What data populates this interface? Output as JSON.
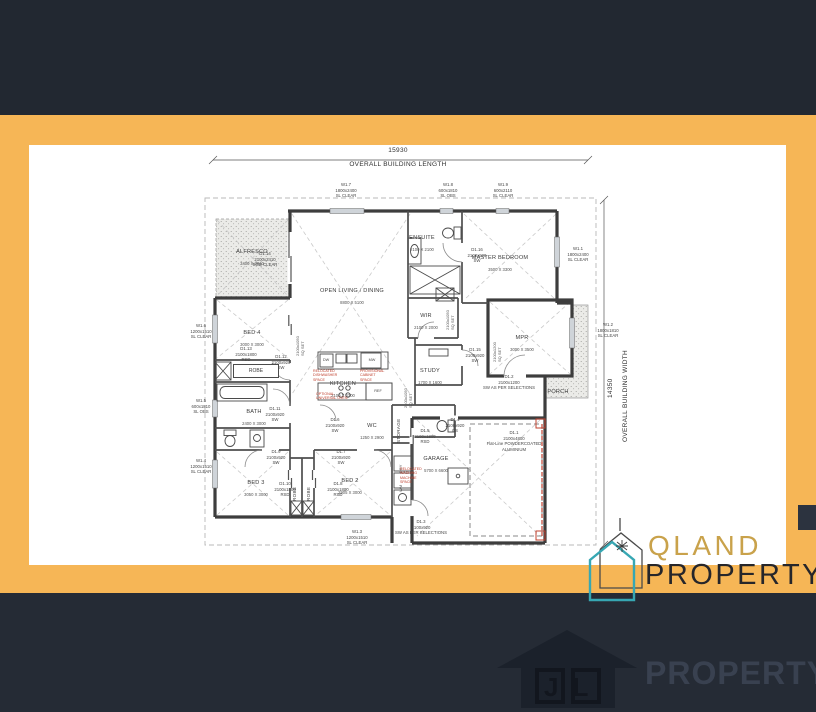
{
  "dimensions": {
    "length_value": "15930",
    "length_label": "OVERALL BUILDING LENGTH",
    "width_value": "14350",
    "width_label": "OVERALL BUILDING WIDTH"
  },
  "windows": {
    "w1_1": "W1.1\n1800x2400\nSL CLEAR",
    "w1_2": "W1.2\n1800x1810\nSL CLEAR",
    "w1_3": "W1.3\n1200x1510\nSL CLEAR",
    "w1_4": "W1.4\n1200x1510\nSL CLEAR",
    "w1_5": "W1.5\n600x1810\nSL OBS",
    "w1_6": "W1.6\n1200x1510\nSL CLEAR",
    "w1_7": "W1.7\n1800x2400\nSL CLEAR",
    "w1_8": "W1.8\n600x1810\nSL OBS",
    "w1_9": "W1.9\n600x2110\nSL CLEAR"
  },
  "doors": {
    "d1_1": "D1.1\n2100x4800\nFlat-Line POWDERCOATED\nALUMINIUM",
    "d1_2": "D1.2\n2100x1200\nSW AS PER SELECTIONS",
    "d1_3": "D1.3\n2100x920\nSW AS PER SELECTIONS",
    "d1_4": "D1.4\n2100x920\nCS",
    "d1_5": "D1.5\n2100x1800\nRSD",
    "d1_6": "D1.6\n2100x920\nSW",
    "d1_7": "D1.7\n2100x920\nSW",
    "d1_8": "D1.8\n2100x1800\nRSD",
    "d1_9": "D1.9\n2100x920\nSW",
    "d1_10": "D1.10\n2100x1800\nRSD",
    "d1_11": "D1.11\n2100x920\nSW",
    "d1_12": "D1.12\n2100x920\nSW",
    "d1_13": "D1.13\n2100x1800\nRSD",
    "d1_14": "D1.14\n2100x2410\nSGD CLEAR",
    "d1_15": "D1.15\n2100x920\nSW",
    "d1_16": "D1.16\n2100x920\nSW"
  },
  "rooms": {
    "alfresco": {
      "name": "ALFRESCO",
      "dims": "3400 X 3010"
    },
    "living": {
      "name": "OPEN LIVING / DINING",
      "dims": "8800 X 5100"
    },
    "ensuite": {
      "name": "ENSUITE",
      "dims": "2100 X 2100"
    },
    "master": {
      "name": "MASTER BEDROOM",
      "dims": "3500 X 3300"
    },
    "wir": {
      "name": "WIR",
      "dims": "2100 X 2000"
    },
    "study": {
      "name": "STUDY",
      "dims": "1700 X 1600"
    },
    "mpr": {
      "name": "MPR",
      "dims": "3000 X 3500"
    },
    "bed4": {
      "name": "BED 4",
      "dims": "3000 X 3000"
    },
    "bath": {
      "name": "BATH",
      "dims": "2400 X 3000"
    },
    "kitchen": {
      "name": "KITCHEN",
      "dims": "2100 X 4300"
    },
    "wc": {
      "name": "WC",
      "dims": "1250 X 2900"
    },
    "bed3": {
      "name": "BED 3",
      "dims": "3050 X 3000"
    },
    "bed2": {
      "name": "BED 2",
      "dims": "2905 X 3000"
    },
    "garage": {
      "name": "GARAGE",
      "dims": "5700 X 6600"
    },
    "porch": {
      "name": "PORCH"
    },
    "robe1": "ROBE",
    "robe2": "ROBE",
    "robe3": "ROBE",
    "storage": "STORAGE"
  },
  "fixtures": {
    "dw": "DW",
    "mw": "MW",
    "ref": "REF",
    "wm": "WM",
    "dry": "DRY"
  },
  "annotations": {
    "sq_set_a": "2100x1050\nSQ SET",
    "sq_set_b": "2100x1050\nSQ SET",
    "sq_set_c": "2100x1050\nSQ SET",
    "sq_set_d": "2100x1200\nSQ SET",
    "note_dw": "RELOCATED\nDISHWASHER\nSPACE",
    "note_cab": "PROVISIONAL\nCABINET\nSPACE",
    "note_oven": "OPTIONAL\nUNIVERSAL OVEN",
    "note_wm": "RELOCATED\nWASHING\nMACHINE\nSPACE"
  },
  "branding": {
    "qland_line1": "QLAND",
    "qland_line2": "PROPERTY",
    "jl_initials": "JL",
    "jl_text": "PROPERTY"
  }
}
